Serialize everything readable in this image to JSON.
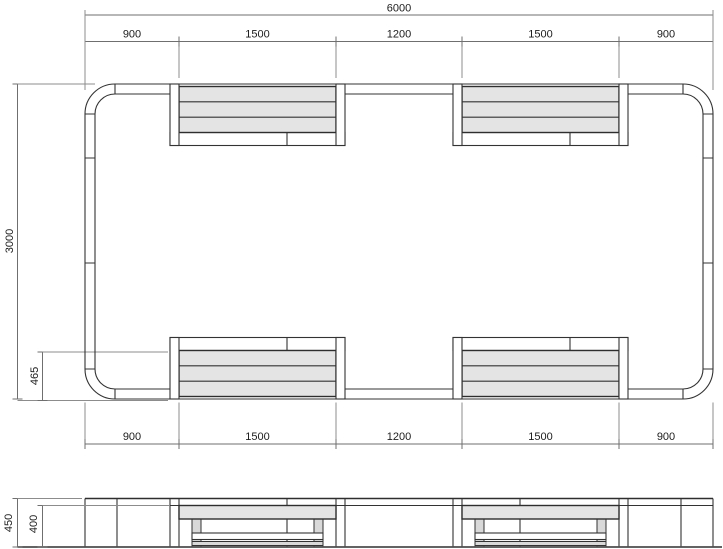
{
  "plan": {
    "top_total": "6000",
    "top_segments": [
      "900",
      "1500",
      "1200",
      "1500",
      "900"
    ],
    "bottom_segments": [
      "900",
      "1500",
      "1200",
      "1500",
      "900"
    ],
    "side_total": "3000",
    "bench_offset": "465"
  },
  "elevation": {
    "overall_height": "450",
    "seat_height": "400"
  },
  "colors": {
    "object_line": "#333333",
    "dim_line": "#6f6f6f",
    "extension_line": "#8c8c8c",
    "slat_fill": "#e4e4e4",
    "leg_fill": "#d9d9d9",
    "background": "#ffffff"
  }
}
